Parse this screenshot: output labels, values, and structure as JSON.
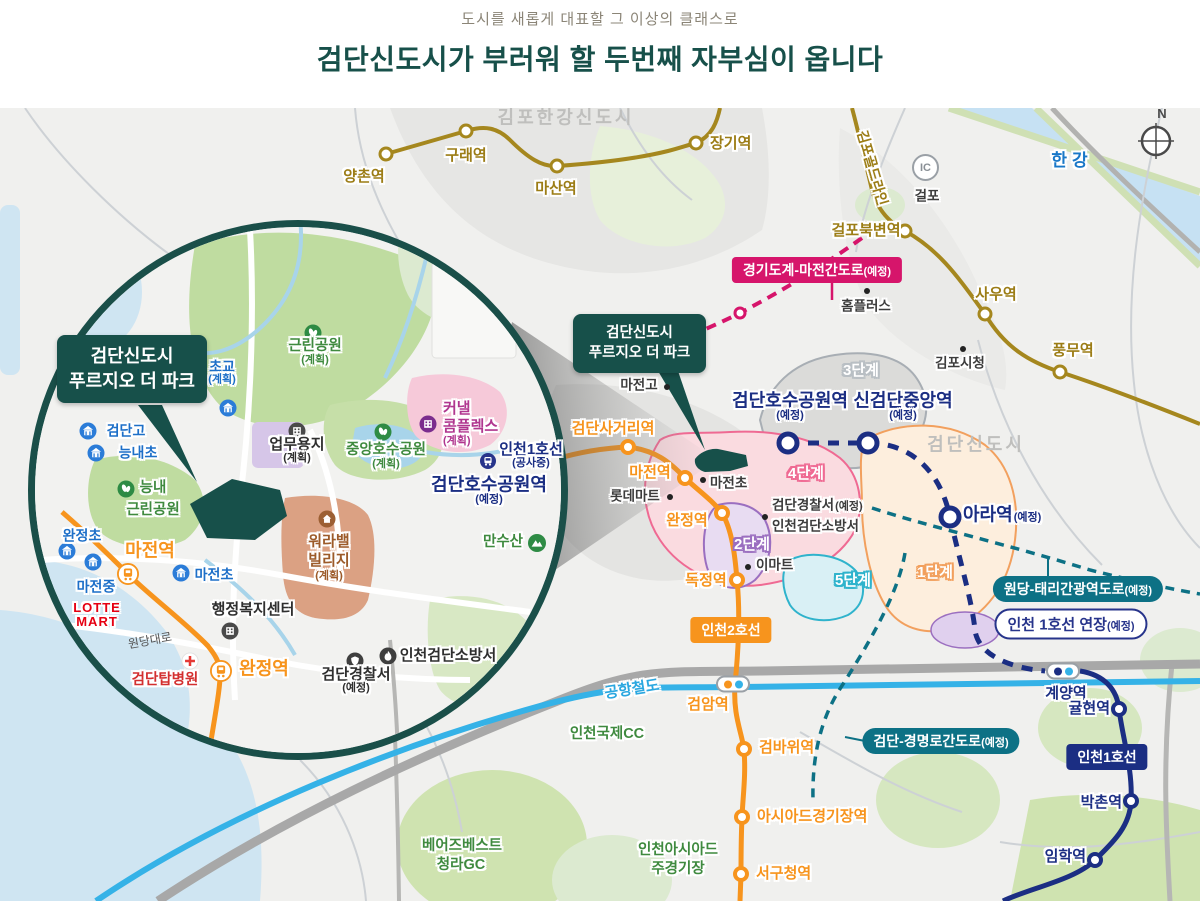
{
  "header": {
    "subtitle": "도시를 새롭게 대표할 그 이상의 클래스로",
    "title": "검단신도시가 부러워 할 두번째 자부심이 옵니다"
  },
  "colors": {
    "accent_teal": "#17504a",
    "gold_line": "#a5871e",
    "navy_line": "#1b2e83",
    "orange_line": "#f7941d",
    "airport_rail": "#35b2e7",
    "pink_road": "#d6156b",
    "teal_road": "#0d7185",
    "highway": "#a8a8a8"
  },
  "map": {
    "callout": {
      "line1": "검단신도시",
      "line2": "푸르지오 더 파크"
    },
    "badges": {
      "pink": {
        "text": "경기도계-마전간도로",
        "sub": "(예정)"
      },
      "wondang": {
        "text": "원당-태리간광역도로",
        "sub": "(예정)"
      },
      "gyeongmyeong": {
        "text": "검단-경명로간도로",
        "sub": "(예정)"
      },
      "line1ext": {
        "text": "인천 1호선 연장",
        "sub": "(예정)"
      },
      "line2": {
        "text": "인천2호선"
      },
      "line1": {
        "text": "인천1호선"
      }
    },
    "compass": "N",
    "ic_badge": {
      "label": "IC"
    },
    "labels": [
      {
        "t": "김포한강신도시",
        "x": 566,
        "y": 118,
        "c": "region"
      },
      {
        "t": "검단신도시",
        "x": 976,
        "y": 445,
        "c": "region"
      },
      {
        "t": "한강",
        "x": 1072,
        "y": 161,
        "c": "river"
      },
      {
        "t": "양촌역",
        "x": 364,
        "y": 177,
        "c": "gold"
      },
      {
        "t": "구래역",
        "x": 466,
        "y": 156,
        "c": "gold"
      },
      {
        "t": "마산역",
        "x": 556,
        "y": 189,
        "c": "gold"
      },
      {
        "t": "장기역",
        "x": 710,
        "y": 144,
        "c": "gold",
        "a": "l"
      },
      {
        "t": "걸포북변역",
        "x": 866,
        "y": 231,
        "c": "gold"
      },
      {
        "t": "사우역",
        "x": 996,
        "y": 295,
        "c": "gold"
      },
      {
        "t": "풍무역",
        "x": 1073,
        "y": 351,
        "c": "gold"
      },
      {
        "t": "김포골드라인",
        "x": 872,
        "y": 168,
        "c": "gold goldline",
        "rot": 74
      },
      {
        "t": "걸포",
        "x": 927,
        "y": 197,
        "c": "darkl"
      },
      {
        "t": "홈플러스",
        "x": 866,
        "y": 307,
        "c": "darkl"
      },
      {
        "t": "김포시청",
        "x": 960,
        "y": 364,
        "c": "darkl"
      },
      {
        "t": "마전고",
        "x": 639,
        "y": 386,
        "c": "darkl"
      },
      {
        "t": "검단호수공원역",
        "x": 790,
        "y": 407,
        "c": "navylg",
        "s": "(예정)",
        "sb": 1
      },
      {
        "t": "신검단중앙역",
        "x": 903,
        "y": 407,
        "c": "navylg",
        "s": "(예정)",
        "sb": 1
      },
      {
        "t": "아라역",
        "x": 963,
        "y": 515,
        "c": "navylg",
        "s": "(예정)",
        "a": "l"
      },
      {
        "t": "검단사거리역",
        "x": 613,
        "y": 429,
        "c": "orangel"
      },
      {
        "t": "마전역",
        "x": 650,
        "y": 473,
        "c": "orangel"
      },
      {
        "t": "완정역",
        "x": 687,
        "y": 521,
        "c": "orangel"
      },
      {
        "t": "독정역",
        "x": 706,
        "y": 581,
        "c": "orangel"
      },
      {
        "t": "롯데마트",
        "x": 635,
        "y": 497,
        "c": "darkl"
      },
      {
        "t": "마전초",
        "x": 710,
        "y": 484,
        "c": "darkl",
        "a": "l"
      },
      {
        "t": "검단경찰서",
        "x": 772,
        "y": 506,
        "c": "darkl",
        "s": "(예정)",
        "a": "l"
      },
      {
        "t": "인천검단소방서",
        "x": 772,
        "y": 527,
        "c": "darkl",
        "a": "l"
      },
      {
        "t": "이마트",
        "x": 756,
        "y": 566,
        "c": "darkl",
        "a": "l"
      },
      {
        "t": "3단계",
        "x": 861,
        "y": 371,
        "c": "phase p3"
      },
      {
        "t": "4단계",
        "x": 806,
        "y": 474,
        "c": "phase p4"
      },
      {
        "t": "2단계",
        "x": 752,
        "y": 545,
        "c": "phase p2"
      },
      {
        "t": "5단계",
        "x": 853,
        "y": 581,
        "c": "phase p5"
      },
      {
        "t": "1단계",
        "x": 935,
        "y": 573,
        "c": "phase p1"
      },
      {
        "t": "검바위역",
        "x": 759,
        "y": 748,
        "c": "orangel",
        "a": "l"
      },
      {
        "t": "아시아드경기장역",
        "x": 757,
        "y": 817,
        "c": "orangel",
        "a": "l"
      },
      {
        "t": "서구청역",
        "x": 756,
        "y": 874,
        "c": "orangel",
        "a": "l"
      },
      {
        "t": "검암역",
        "x": 708,
        "y": 705,
        "c": "orangel"
      },
      {
        "t": "계양역",
        "x": 1066,
        "y": 694,
        "c": "navyl"
      },
      {
        "t": "귤현역",
        "x": 1110,
        "y": 709,
        "c": "navyl",
        "a": "r"
      },
      {
        "t": "박촌역",
        "x": 1122,
        "y": 803,
        "c": "navyl",
        "a": "r"
      },
      {
        "t": "임학역",
        "x": 1086,
        "y": 857,
        "c": "navyl",
        "a": "r"
      },
      {
        "t": "인천국제CC",
        "x": 607,
        "y": 735,
        "c": "greenl"
      },
      {
        "t": "인천아시아드",
        "x": 678,
        "y": 851,
        "c": "greenl"
      },
      {
        "t": "주경기장",
        "x": 678,
        "y": 870,
        "c": "greenl"
      },
      {
        "t": "베어즈베스트",
        "x": 462,
        "y": 847,
        "c": "greenl"
      },
      {
        "t": "청라GC",
        "x": 461,
        "y": 866,
        "c": "greenl"
      },
      {
        "t": "공항철도",
        "x": 632,
        "y": 690,
        "c": "railblue",
        "rot": -9
      },
      {
        "t": "근린공원",
        "x": 315,
        "y": 353,
        "c": "greenl",
        "s": "(계획)",
        "sb": 1
      },
      {
        "t": "초교",
        "x": 222,
        "y": 373,
        "c": "bluel",
        "s": "(계획)",
        "sb": 1
      },
      {
        "t": "검단고",
        "x": 126,
        "y": 431,
        "c": "bluel"
      },
      {
        "t": "능내초",
        "x": 138,
        "y": 453,
        "c": "bluel"
      },
      {
        "t": "능내",
        "x": 153,
        "y": 489,
        "c": "greenl"
      },
      {
        "t": "근린공원",
        "x": 153,
        "y": 511,
        "c": "greenl"
      },
      {
        "t": "업무용지",
        "x": 297,
        "y": 451,
        "c": "darklg",
        "s": "(계획)",
        "sb": 1
      },
      {
        "t": "중앙호수공원",
        "x": 386,
        "y": 457,
        "c": "greenl",
        "s": "(계획)",
        "sb": 1
      },
      {
        "t": "커낼",
        "x": 443,
        "y": 409,
        "c": "magenta",
        "a": "l"
      },
      {
        "t": "콤플렉스",
        "x": 443,
        "y": 427,
        "c": "magenta",
        "a": "l"
      },
      {
        "t": "(계획)",
        "x": 443,
        "y": 442,
        "c": "magenta sub-only",
        "a": "l"
      },
      {
        "t": "인천1호선",
        "x": 531,
        "y": 456,
        "c": "navyl",
        "s": "(공사중)",
        "sb": 1
      },
      {
        "t": "검단호수공원역",
        "x": 489,
        "y": 491,
        "c": "navylg",
        "s": "(예정)",
        "sb": 1
      },
      {
        "t": "워라밸",
        "x": 329,
        "y": 542,
        "c": "brown"
      },
      {
        "t": "빌리지",
        "x": 329,
        "y": 561,
        "c": "brown"
      },
      {
        "t": "(계획)",
        "x": 329,
        "y": 577,
        "c": "brown sub-only"
      },
      {
        "t": "만수산",
        "x": 503,
        "y": 543,
        "c": "greenl"
      },
      {
        "t": "행정복지센터",
        "x": 253,
        "y": 610,
        "c": "darklg"
      },
      {
        "t": "원당대로",
        "x": 150,
        "y": 641,
        "c": "roadlbl",
        "rot": -10
      },
      {
        "t": "완정역",
        "x": 264,
        "y": 669,
        "c": "orangexl"
      },
      {
        "t": "검단탑병원",
        "x": 165,
        "y": 681,
        "c": "redl"
      },
      {
        "t": "LOTTE",
        "x": 97,
        "y": 608,
        "c": "lotte"
      },
      {
        "t": "MART",
        "x": 97,
        "y": 622,
        "c": "lotte"
      },
      {
        "t": "마전역",
        "x": 150,
        "y": 551,
        "c": "orangexl"
      },
      {
        "t": "완정초",
        "x": 82,
        "y": 536,
        "c": "bluel"
      },
      {
        "t": "마전중",
        "x": 96,
        "y": 587,
        "c": "bluel"
      },
      {
        "t": "마전초",
        "x": 214,
        "y": 575,
        "c": "bluel"
      },
      {
        "t": "검단경찰서",
        "x": 356,
        "y": 681,
        "c": "darklg",
        "s": "(예정)",
        "sb": 1
      },
      {
        "t": "인천검단소방서",
        "x": 448,
        "y": 656,
        "c": "darklg"
      }
    ],
    "icons": [
      {
        "k": "dot",
        "x": 867,
        "y": 291
      },
      {
        "k": "dot",
        "x": 963,
        "y": 349
      },
      {
        "k": "dot",
        "x": 667,
        "y": 387
      },
      {
        "k": "dot",
        "x": 703,
        "y": 480
      },
      {
        "k": "dot",
        "x": 670,
        "y": 497
      },
      {
        "k": "dot",
        "x": 765,
        "y": 517
      },
      {
        "k": "dot",
        "x": 748,
        "y": 567
      },
      {
        "k": "school",
        "x": 228,
        "y": 408
      },
      {
        "k": "school",
        "x": 88,
        "y": 431
      },
      {
        "k": "school",
        "x": 96,
        "y": 453
      },
      {
        "k": "school",
        "x": 67,
        "y": 551
      },
      {
        "k": "school",
        "x": 93,
        "y": 562
      },
      {
        "k": "school",
        "x": 181,
        "y": 573
      },
      {
        "k": "park",
        "x": 313,
        "y": 333
      },
      {
        "k": "park",
        "x": 126,
        "y": 489
      },
      {
        "k": "park",
        "x": 383,
        "y": 432
      },
      {
        "k": "bldg",
        "x": 297,
        "y": 431
      },
      {
        "k": "bldg",
        "x": 230,
        "y": 631
      },
      {
        "k": "bldg2",
        "x": 428,
        "y": 424
      },
      {
        "k": "train",
        "x": 488,
        "y": 461
      },
      {
        "k": "village",
        "x": 327,
        "y": 519
      },
      {
        "k": "mtn",
        "x": 537,
        "y": 543
      },
      {
        "k": "hosp",
        "x": 190,
        "y": 661
      },
      {
        "k": "police",
        "x": 355,
        "y": 661
      },
      {
        "k": "fire",
        "x": 388,
        "y": 656
      },
      {
        "k": "sta",
        "x": 128,
        "y": 574
      },
      {
        "k": "sta",
        "x": 221,
        "y": 671
      }
    ],
    "stations": [
      {
        "l": "gold",
        "x": 386,
        "y": 154
      },
      {
        "l": "gold",
        "x": 466,
        "y": 131
      },
      {
        "l": "gold",
        "x": 557,
        "y": 166
      },
      {
        "l": "gold",
        "x": 696,
        "y": 143
      },
      {
        "l": "gold",
        "x": 905,
        "y": 231
      },
      {
        "l": "gold",
        "x": 985,
        "y": 314
      },
      {
        "l": "gold",
        "x": 1060,
        "y": 372
      },
      {
        "l": "navyb",
        "x": 788,
        "y": 443
      },
      {
        "l": "navyb",
        "x": 868,
        "y": 443
      },
      {
        "l": "navyb",
        "x": 950,
        "y": 517
      },
      {
        "l": "navys",
        "x": 1119,
        "y": 709
      },
      {
        "l": "navys",
        "x": 1131,
        "y": 801
      },
      {
        "l": "navys",
        "x": 1095,
        "y": 860
      },
      {
        "l": "org",
        "x": 628,
        "y": 447
      },
      {
        "l": "org",
        "x": 685,
        "y": 478
      },
      {
        "l": "org",
        "x": 722,
        "y": 513
      },
      {
        "l": "org",
        "x": 737,
        "y": 580
      },
      {
        "l": "org",
        "x": 744,
        "y": 749
      },
      {
        "l": "org",
        "x": 742,
        "y": 817
      },
      {
        "l": "org",
        "x": 741,
        "y": 874
      },
      {
        "l": "pinkj",
        "x": 740,
        "y": 313
      }
    ],
    "pills": [
      {
        "x": 733,
        "y": 684,
        "c1": "#f7941d",
        "c2": "#35b2e7"
      },
      {
        "x": 1063,
        "y": 671,
        "c1": "#1b2e83",
        "c2": "#35b2e7"
      }
    ]
  }
}
